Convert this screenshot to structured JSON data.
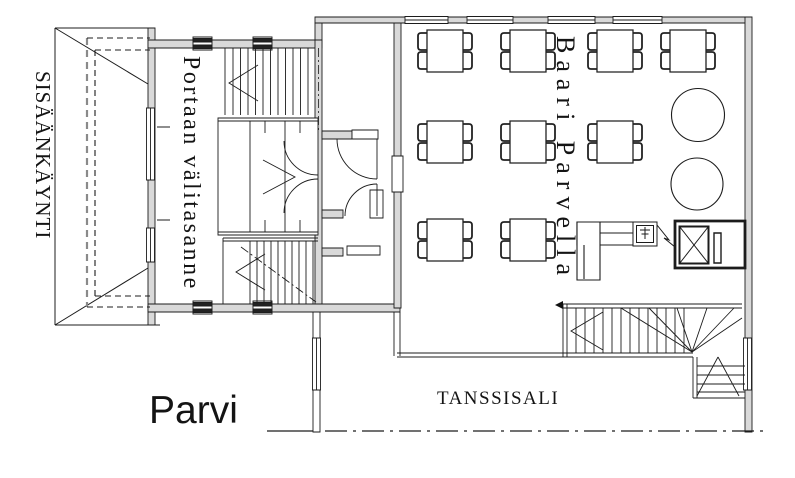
{
  "plan": {
    "floor_label": "Parvi",
    "rooms": {
      "entrance": "SISÄÄNKÄYNTI",
      "stair_landing": "Portaan välitasanne",
      "bar_loft": "Baari Parvella",
      "dance_hall": "TANSSISALI"
    },
    "furniture": {
      "square_tables": 9,
      "chairs_per_table": 4,
      "round_tables": 2,
      "bar_counter": 1,
      "sink": 1,
      "dumbwaiter": 1
    }
  }
}
